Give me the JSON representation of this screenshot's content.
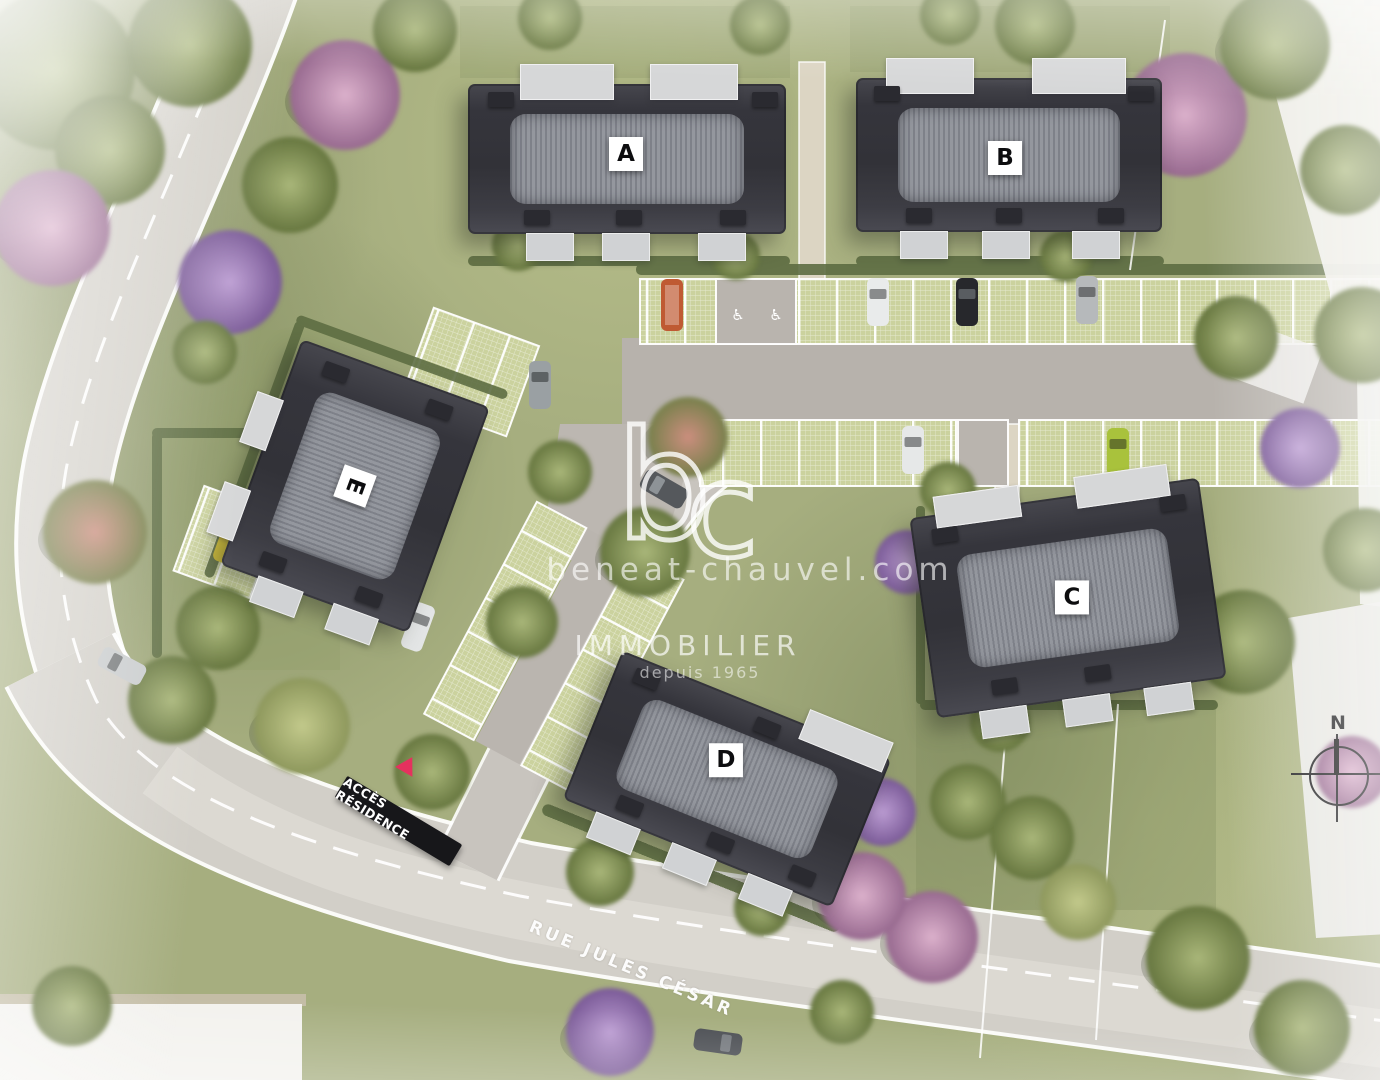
{
  "buildings": [
    {
      "id": "A",
      "label": "A"
    },
    {
      "id": "B",
      "label": "B"
    },
    {
      "id": "C",
      "label": "C"
    },
    {
      "id": "D",
      "label": "D"
    },
    {
      "id": "E",
      "label": "E"
    }
  ],
  "watermark": {
    "logo_b": "b",
    "logo_c": "c",
    "site": "beneat-chauvel.com",
    "brand": "IMMOBILIER",
    "tagline": "depuis 1965"
  },
  "signs": {
    "residence_access": "ACCÈS RÉSIDENCE",
    "street": "RUE JULES CÉSAR"
  },
  "compass": {
    "north": "N"
  },
  "parking": {
    "disabled_icon": "♿"
  },
  "colors": {
    "grass": "#a6ae7f",
    "road": "#d4d1ca",
    "asphalt": "#b7b2ac",
    "paver": "#cbd29e",
    "roof": "#3a3a41",
    "roof_band": "#8d8f96",
    "sign_black": "#17171a",
    "sign_red": "#e5315e"
  }
}
